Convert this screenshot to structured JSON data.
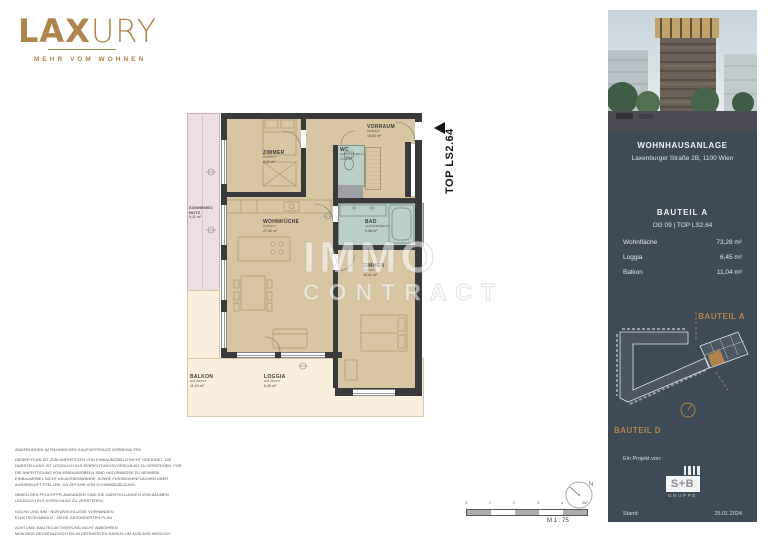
{
  "brand": {
    "logo_primary": "LAX",
    "logo_secondary": "URY",
    "tagline": "MEHR VOM WOHNEN"
  },
  "plan": {
    "unit_marker": "TOP LS2.64",
    "rooms": [
      {
        "name": "ZIMMER",
        "material": "PARKETT",
        "area": "9,21 m²"
      },
      {
        "name": "VORRAUM",
        "material": "PARKETT",
        "area": "10,84 m²"
      },
      {
        "name": "WC",
        "material": "FEINSTEINZEUG",
        "area": "1,52 m²"
      },
      {
        "name": "WOHNKÜCHE",
        "material": "PARKETT",
        "area": "27,32 m²"
      },
      {
        "name": "BAD",
        "material": "FEINSTEINZEUG",
        "area": "5,98 m²"
      },
      {
        "name": "ZIMMER",
        "material": "PARKETT",
        "area": "18,41 m²"
      },
      {
        "name": "SONNENSCHUTZ",
        "area": "9,11 m²"
      },
      {
        "name": "BALKON",
        "material": "HOLZROST",
        "area": "11,04 m²"
      },
      {
        "name": "LOGGIA",
        "material": "HOLZROST",
        "area": "6,45 m²"
      }
    ],
    "scale": {
      "ticks": [
        "0",
        "1",
        "2",
        "3",
        "4",
        "5M"
      ],
      "label": "M 1 : 75"
    },
    "compass_label": "N"
  },
  "watermark": {
    "line1": "IMMO",
    "line2": "CONTRACT"
  },
  "sidebar": {
    "project_title": "WOHNHAUSANLAGE",
    "project_address": "Laxenburger Straße 2B, 1100 Wien",
    "building_title": "BAUTEIL A",
    "unit_line": "OG 09 | TOP LS2.64",
    "stats": [
      {
        "label": "Wohnfläche",
        "value": "73,28 m²"
      },
      {
        "label": "Loggia",
        "value": "6,45 m²"
      },
      {
        "label": "Balkon",
        "value": "11,04 m²"
      }
    ],
    "siteplan": {
      "bauteil_a": "BAUTEIL A",
      "bauteil_d": "BAUTEIL D"
    },
    "project_by": "Ein Projekt von:",
    "partner_logo": {
      "line1": "S+B",
      "line2": "GRUPPE"
    },
    "stand_label": "Stand:",
    "stand_date": "25.01.2024"
  },
  "disclaimer": [
    "ÄNDERUNGEN IM RAHMEN DES KAUFVERTRAGS VORBEHALTEN",
    "DIESER PLAN IST ZUM ANFERTIGEN VON EINBAUMÖBELN NICHT GEEIGNET. DIE DARSTELLUNG IST LEDIGLICH ALS EINRICHTUNGSVORSCHLAG ZU VERSTEHEN. FÜR DIE ANFERTIGUNG VON EINBAUMÖBELN SIND NATURMASSE ZU NEHMEN! EINBAUMÖBEL NICHT AN AUSSENWÄNDE, SOWIE FUSSBODENFLÄCHEN ÜBER AUSSENLUFT STELLEN, DA GEFAHR VON SCHIMMELBILDUNG.",
    "NEBEN DEN PFLICHTPFLANZUNGEN SIND DIE DARSTELLUNGEN VON BÄUMEN LEDIGLICH ALS VORSCHLAG ZU VERSTEHEN.",
    "KÜCHE UND WM : NUR ANSCHLÜSSE VORHANDEN\nELEKTROSYMBOLE : SIEHE GESONDERTEN PLAN",
    "ACHTUNG: BAUTEILAKTIVIERUNG NICHT ANBOHREN\nMONTAGE DECKENLEUCHTEN IM DEFINIERTEN RADIUS UM AUSLASS MÖGLICH"
  ],
  "colors": {
    "accent_bronze": "#b0854d",
    "sidebar_bg": "#3e4a55",
    "room_fill": "#d8c6a2",
    "wet_room_fill": "#bad0c6",
    "sun_strip_fill": "#efdee1",
    "outdoor_fill": "#f9efdc",
    "wall": "#3a3a3c"
  }
}
